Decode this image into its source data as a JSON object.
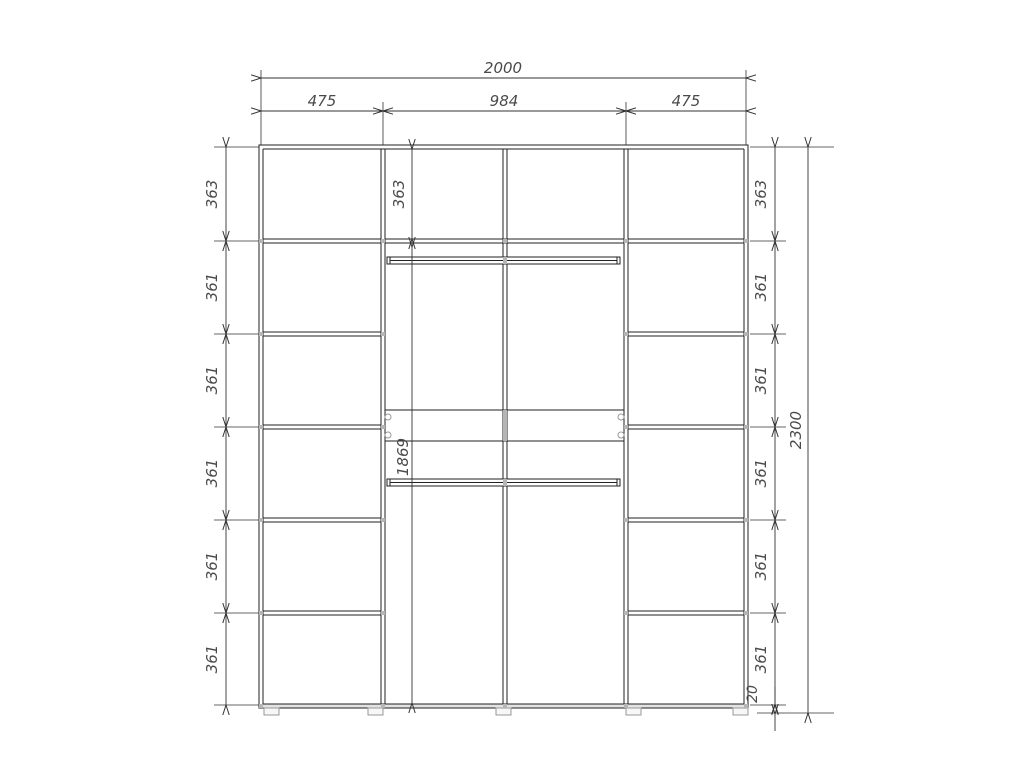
{
  "dimensions": {
    "overall_width": "2000",
    "left_section_width": "475",
    "middle_section_width": "984",
    "right_section_width": "475",
    "total_height": "2300",
    "middle_top_compartment_height": "363",
    "middle_interior_height": "1869",
    "plinth_height": "20",
    "left_compartment_heights": [
      "363",
      "361",
      "361",
      "361",
      "361",
      "361"
    ],
    "right_compartment_heights": [
      "363",
      "361",
      "361",
      "361",
      "361",
      "361"
    ]
  }
}
